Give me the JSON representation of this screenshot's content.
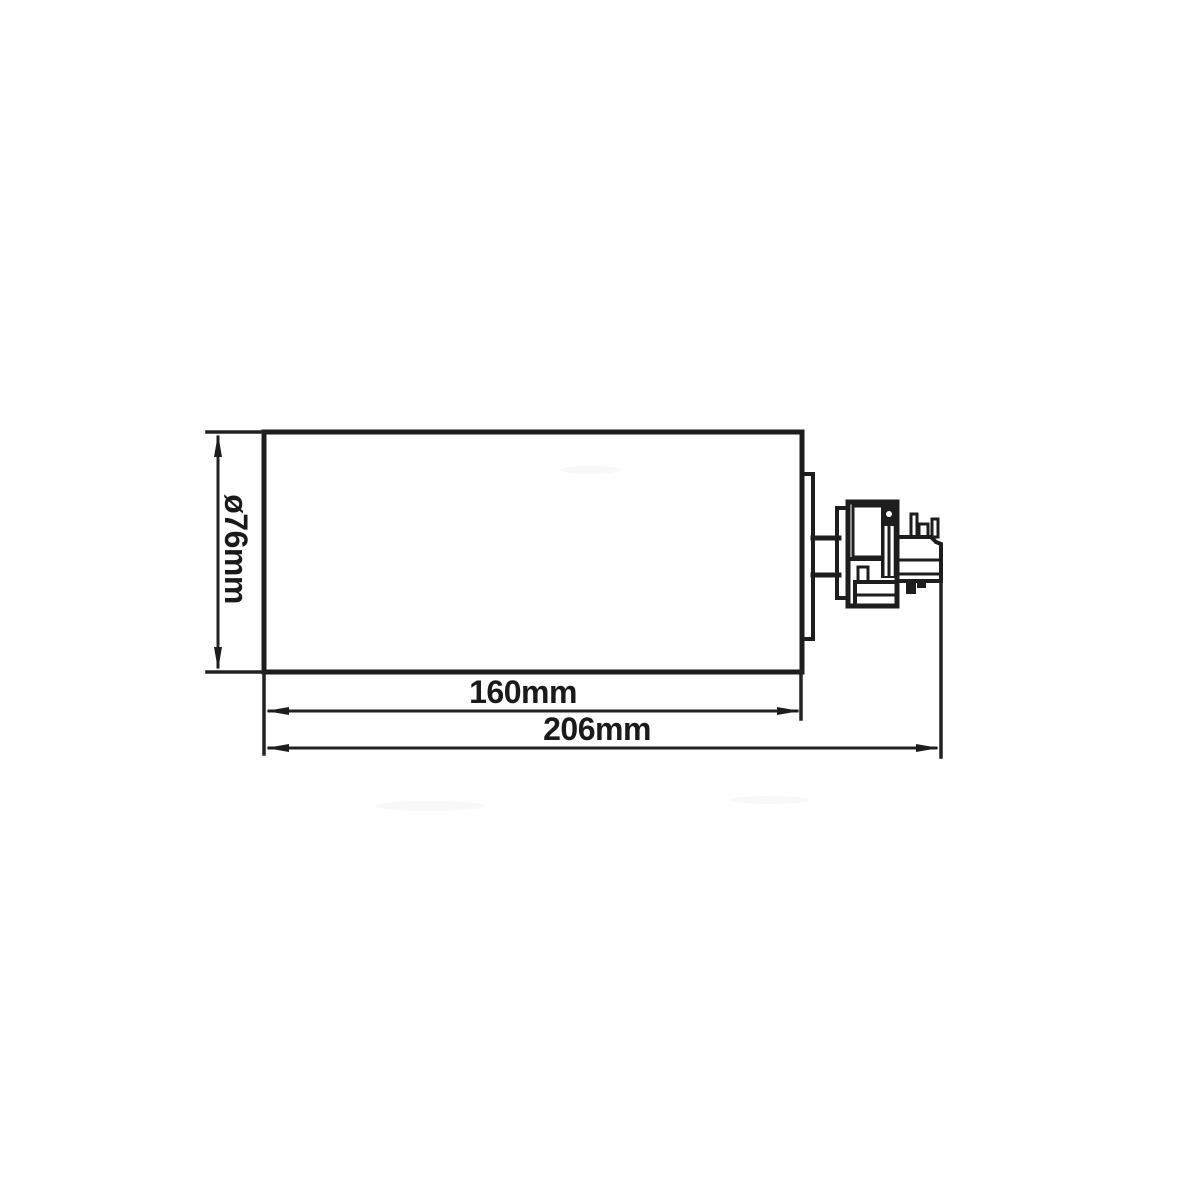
{
  "colors": {
    "background": "#ffffff",
    "line": "#1d1d1d",
    "text": "#1a1a1a"
  },
  "dimensions": {
    "diameter": {
      "label": "ø76mm"
    },
    "body_length": {
      "label": "160mm"
    },
    "overall_length": {
      "label": "206mm"
    }
  }
}
